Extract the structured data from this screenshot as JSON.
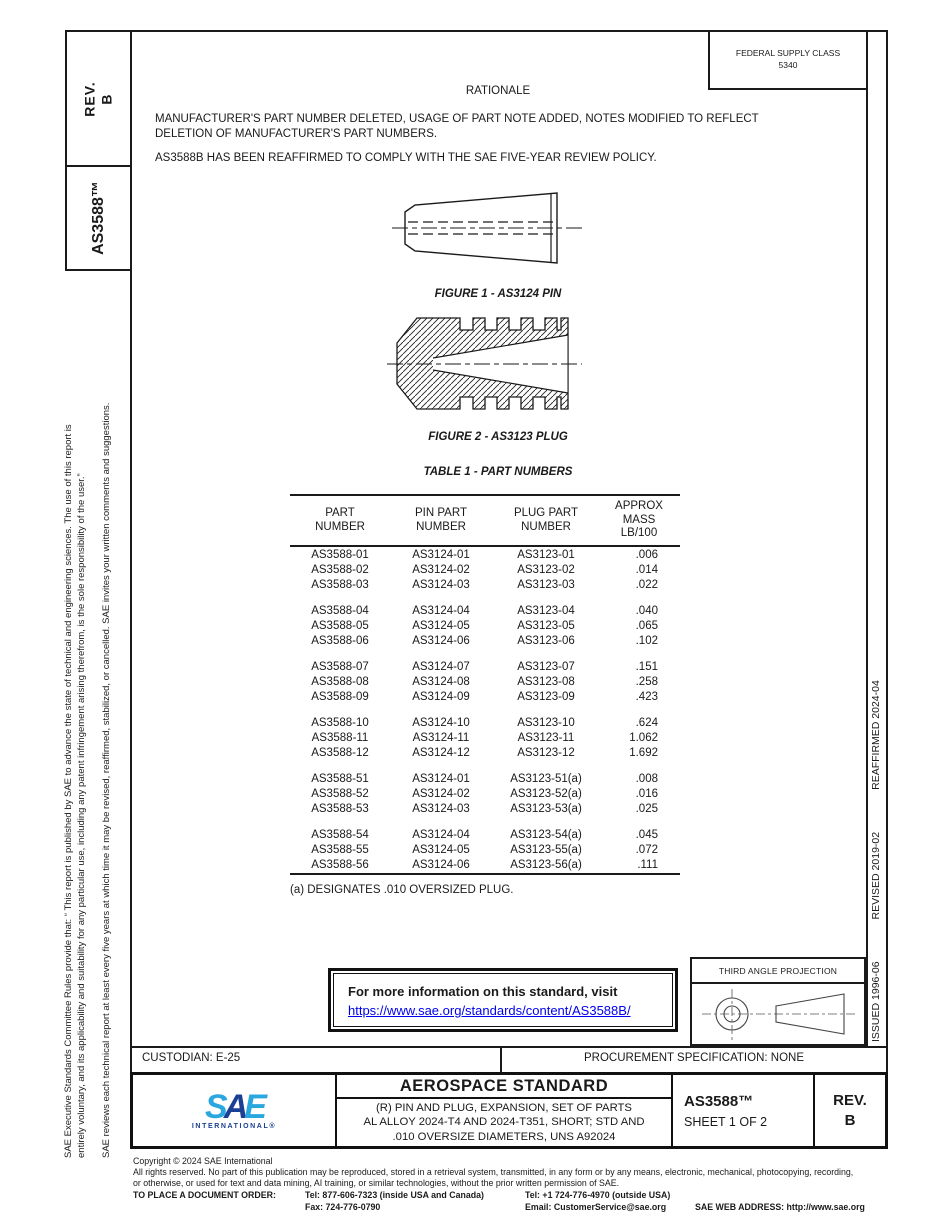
{
  "colors": {
    "link": "#0000EE",
    "sae_light_blue": "#2BA7DF",
    "sae_dark_blue": "#1B3F94",
    "ink": "#1a1a1a"
  },
  "header": {
    "federal_supply_class": "FEDERAL SUPPLY CLASS\n5340",
    "rev_box": "REV.\nB",
    "doc_number_vertical": "AS3588™"
  },
  "rationale": {
    "heading": "RATIONALE",
    "para1": "MANUFACTURER'S PART NUMBER DELETED, USAGE OF PART NOTE ADDED, NOTES MODIFIED TO REFLECT\nDELETION OF MANUFACTURER'S PART NUMBERS.",
    "para2": "AS3588B HAS BEEN REAFFIRMED TO COMPLY WITH THE SAE FIVE-YEAR REVIEW POLICY."
  },
  "figures": {
    "fig1_caption": "FIGURE 1 - AS3124 PIN",
    "fig2_caption": "FIGURE 2 - AS3123 PLUG"
  },
  "table": {
    "title": "TABLE 1 - PART NUMBERS",
    "headers": [
      "PART\nNUMBER",
      "PIN PART\nNUMBER",
      "PLUG PART\nNUMBER",
      "APPROX\nMASS\nLB/100"
    ],
    "groups": [
      [
        [
          "AS3588-01",
          "AS3124-01",
          "AS3123-01",
          ".006"
        ],
        [
          "AS3588-02",
          "AS3124-02",
          "AS3123-02",
          ".014"
        ],
        [
          "AS3588-03",
          "AS3124-03",
          "AS3123-03",
          ".022"
        ]
      ],
      [
        [
          "AS3588-04",
          "AS3124-04",
          "AS3123-04",
          ".040"
        ],
        [
          "AS3588-05",
          "AS3124-05",
          "AS3123-05",
          ".065"
        ],
        [
          "AS3588-06",
          "AS3124-06",
          "AS3123-06",
          ".102"
        ]
      ],
      [
        [
          "AS3588-07",
          "AS3124-07",
          "AS3123-07",
          ".151"
        ],
        [
          "AS3588-08",
          "AS3124-08",
          "AS3123-08",
          ".258"
        ],
        [
          "AS3588-09",
          "AS3124-09",
          "AS3123-09",
          ".423"
        ]
      ],
      [
        [
          "AS3588-10",
          "AS3124-10",
          "AS3123-10",
          ".624"
        ],
        [
          "AS3588-11",
          "AS3124-11",
          "AS3123-11",
          "1.062"
        ],
        [
          "AS3588-12",
          "AS3124-12",
          "AS3123-12",
          "1.692"
        ]
      ],
      [
        [
          "AS3588-51",
          "AS3124-01",
          "AS3123-51(a)",
          ".008"
        ],
        [
          "AS3588-52",
          "AS3124-02",
          "AS3123-52(a)",
          ".016"
        ],
        [
          "AS3588-53",
          "AS3124-03",
          "AS3123-53(a)",
          ".025"
        ]
      ],
      [
        [
          "AS3588-54",
          "AS3124-04",
          "AS3123-54(a)",
          ".045"
        ],
        [
          "AS3588-55",
          "AS3124-05",
          "AS3123-55(a)",
          ".072"
        ],
        [
          "AS3588-56",
          "AS3124-06",
          "AS3123-56(a)",
          ".111"
        ]
      ]
    ],
    "footnote": "(a)  DESIGNATES .010 OVERSIZED PLUG."
  },
  "info_box": {
    "line1": "For more information on this standard, visit",
    "link": "https://www.sae.org/standards/content/AS3588B/"
  },
  "projection": {
    "title": "THIRD ANGLE PROJECTION"
  },
  "revision_history": {
    "issued": "ISSUED 1996-06",
    "revised": "REVISED 2019-02",
    "reaffirmed": "REAFFIRMED 2024-04"
  },
  "left_disclaimer": {
    "col1": "SAE Executive Standards Committee Rules provide that: “ This report is published by SAE to advance the state of technical and engineering sciences. The use of this report is\nentirely voluntary, and its applicability and suitability for any particular use, including any patent infringement arising therefrom, is the sole responsibility of the user.”",
    "col2": "SAE reviews each technical report at least every five years at which time it may be revised, reaffirmed, stabilized, or cancelled. SAE invites your written comments and suggestions."
  },
  "custodian_row": {
    "custodian": "CUSTODIAN: E-25",
    "procurement": "PROCUREMENT SPECIFICATION: NONE"
  },
  "title_block": {
    "logo": {
      "s": "S",
      "a": "A",
      "e": "E",
      "sub": "INTERNATIONAL®"
    },
    "doc_type": "AEROSPACE STANDARD",
    "title_lines": [
      "(R) PIN AND PLUG, EXPANSION, SET OF PARTS",
      "AL ALLOY 2024-T4 AND 2024-T351, SHORT; STD AND",
      ".010 OVERSIZE DIAMETERS, UNS A92024"
    ],
    "doc_number": "AS3588™",
    "sheet": "SHEET 1 OF 2",
    "rev": "REV.\nB"
  },
  "footer": {
    "copyright": "Copyright © 2024 SAE International",
    "rights_line1": "All rights reserved. No part of this publication may be reproduced, stored in a retrieval system, transmitted, in any form or by any means, electronic, mechanical, photocopying, recording,",
    "rights_line2": "or otherwise, or used for text and data mining, AI training, or similar technologies, without the prior written permission of SAE.",
    "order_label": "TO PLACE A DOCUMENT ORDER:",
    "tel_inside": "Tel: 877-606-7323 (inside USA and Canada)",
    "tel_outside": "Tel: +1 724-776-4970 (outside USA)",
    "fax": "Fax: 724-776-0790",
    "email": "Email: CustomerService@sae.org",
    "web": "SAE WEB ADDRESS: http://www.sae.org"
  }
}
